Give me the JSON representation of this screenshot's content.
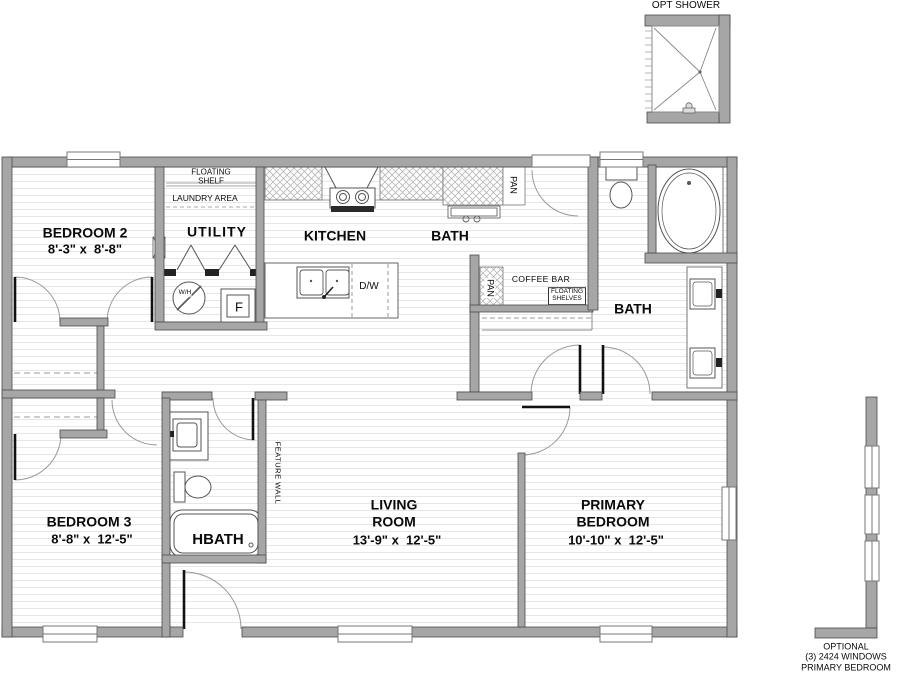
{
  "plan": {
    "opt_shower_label": "OPT SHOWER",
    "rooms": {
      "bedroom2": {
        "name": "BEDROOM 2",
        "dims": "8'-3\" x  8'-8\""
      },
      "utility": {
        "name": "UTILITY"
      },
      "kitchen": {
        "name": "KITCHEN"
      },
      "hall_bath": {
        "name": "BATH"
      },
      "primary_bath": {
        "name": "BATH"
      },
      "bedroom3": {
        "name": "BEDROOM 3",
        "dims": "8'-8\" x  12'-5\""
      },
      "hbath": {
        "name": "HBATH"
      },
      "living": {
        "name": "LIVING\nROOM",
        "dims": "13'-9\" x  12'-5\""
      },
      "primary": {
        "name": "PRIMARY\nBEDROOM",
        "dims": "10'-10\" x  12'-5\""
      }
    },
    "annotations": {
      "floating_shelf": "FLOATING\nSHELF",
      "laundry_area": "LAUNDRY AREA",
      "pan_upper": "PAN",
      "pan_lower": "PAN",
      "coffee_bar": "COFFEE BAR",
      "floating_shelves": "FLOATING\nSHELVES",
      "feature_wall": "FEATURE WALL",
      "dishwasher": "D/W",
      "water_heater": "W/H",
      "furnace": "F",
      "optional_note": "OPTIONAL\n(3) 2424 WINDOWS\nPRIMARY BEDROOM"
    },
    "colors": {
      "wall": "#a6a6a6",
      "wall_edge": "#4a4a4a",
      "floor_line": "#e6e6e6",
      "hatch": "#b8b8b8"
    }
  }
}
